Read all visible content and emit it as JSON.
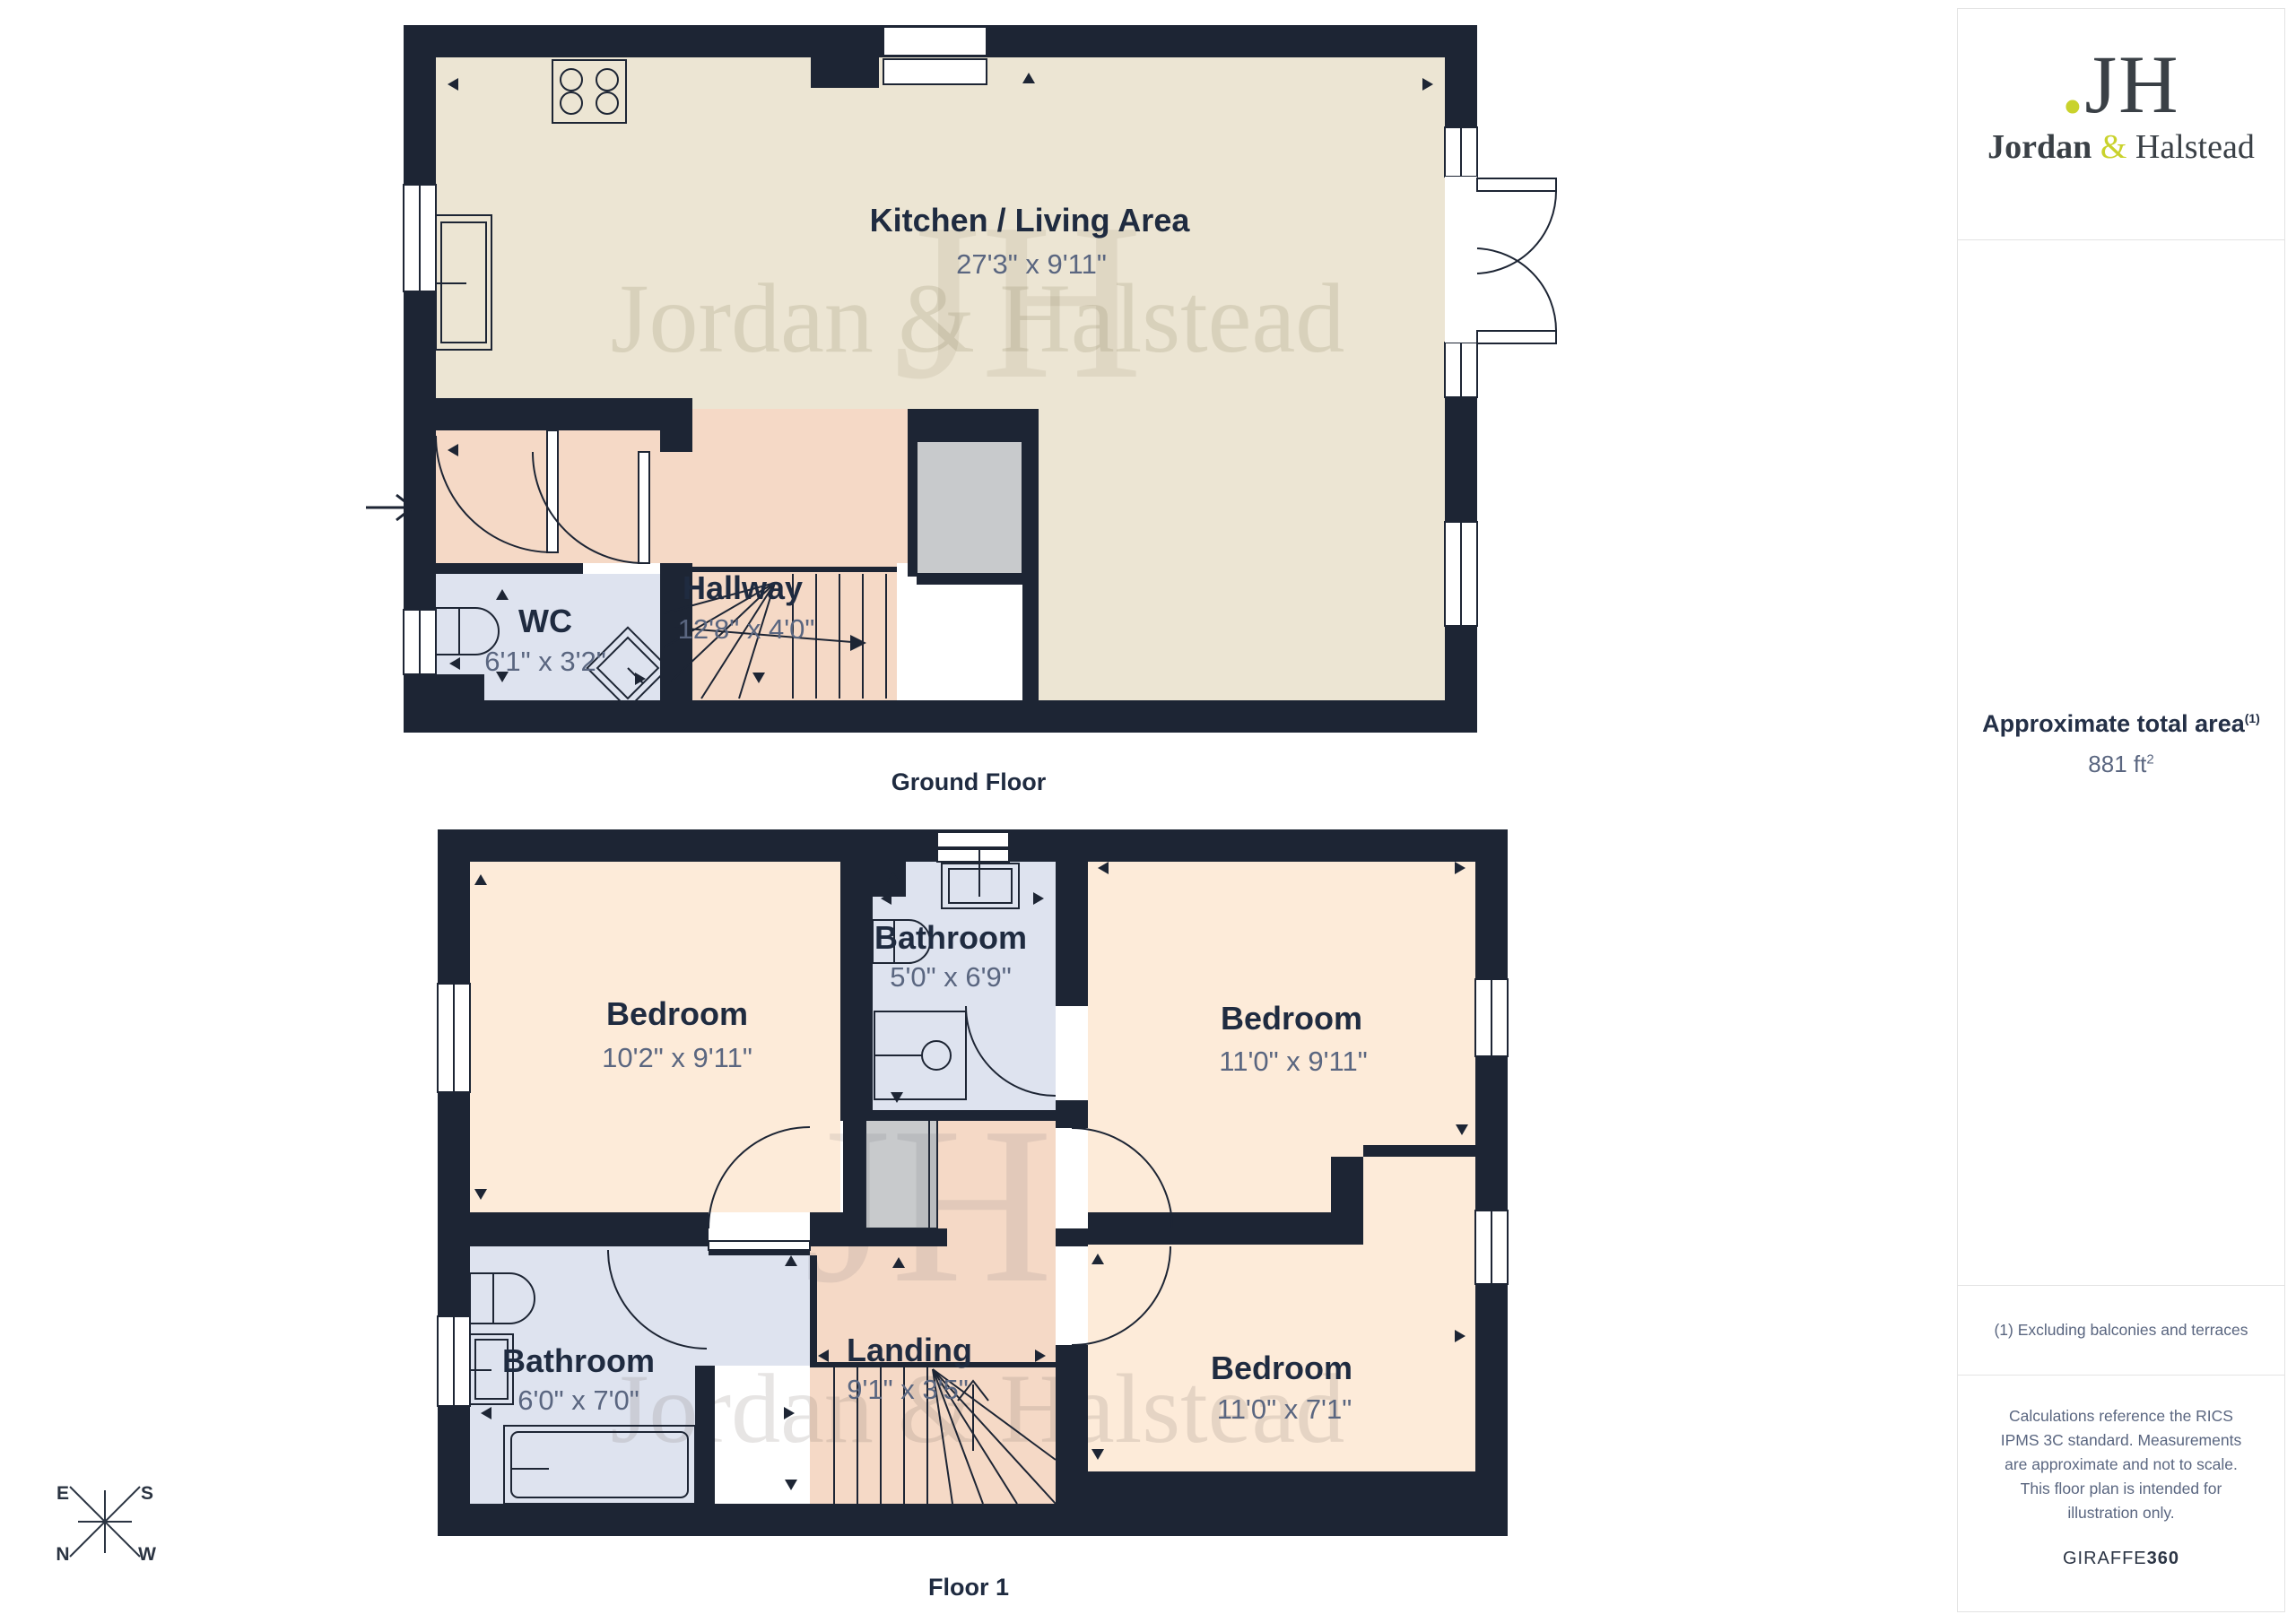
{
  "sidebar": {
    "logo": {
      "dot": ".",
      "monogram": "JH",
      "name_primary": "Jordan",
      "ampersand": "&",
      "name_secondary": "Halstead"
    },
    "area": {
      "label": "Approximate total area",
      "footnote_ref": "(1)",
      "value": "881 ft",
      "unit_exponent": "2"
    },
    "footnote": "(1) Excluding balconies and terraces",
    "disclaimer": "Calculations reference the RICS IPMS 3C standard. Measurements are approximate and not to scale. This floor plan is intended for illustration only.",
    "brand": {
      "name": "GIRAFFE",
      "suffix": "360"
    }
  },
  "ground_floor": {
    "title": "Ground Floor",
    "rooms": {
      "kitchen": {
        "name": "Kitchen / Living Area",
        "dims": "27'3\" x 9'11\""
      },
      "hallway": {
        "name": "Hallway",
        "dims": "12'8\" x 4'0\""
      },
      "wc": {
        "name": "WC",
        "dims": "6'1\" x 3'2\""
      }
    }
  },
  "floor_1": {
    "title": "Floor 1",
    "rooms": {
      "bedroom_1": {
        "name": "Bedroom",
        "dims": "10'2\" x 9'11\""
      },
      "bathroom_1": {
        "name": "Bathroom",
        "dims": "5'0\" x 6'9\""
      },
      "bedroom_2": {
        "name": "Bedroom",
        "dims": "11'0\" x 9'11\""
      },
      "bathroom_2": {
        "name": "Bathroom",
        "dims": "6'0\" x 7'0\""
      },
      "landing": {
        "name": "Landing",
        "dims": "9'1\" x 3'5\""
      },
      "bedroom_3": {
        "name": "Bedroom",
        "dims": "11'0\" x 7'1\""
      }
    }
  },
  "compass": {
    "east": "E",
    "south": "S",
    "north": "N",
    "west": "W"
  },
  "watermark": {
    "monogram": "JH",
    "name": "Jordan & Halstead"
  },
  "colors": {
    "wall": "#1d2534",
    "kitchen_floor": "#ece5d3",
    "hallway_floor": "#f5d9c6",
    "bedroom_floor": "#fdebd9",
    "bathroom_floor": "#dee3ef",
    "storage_floor": "#c8cacc",
    "accent_yellow": "#c9d22c",
    "label_text": "#1f2b40",
    "dims_text": "#5a6680"
  }
}
